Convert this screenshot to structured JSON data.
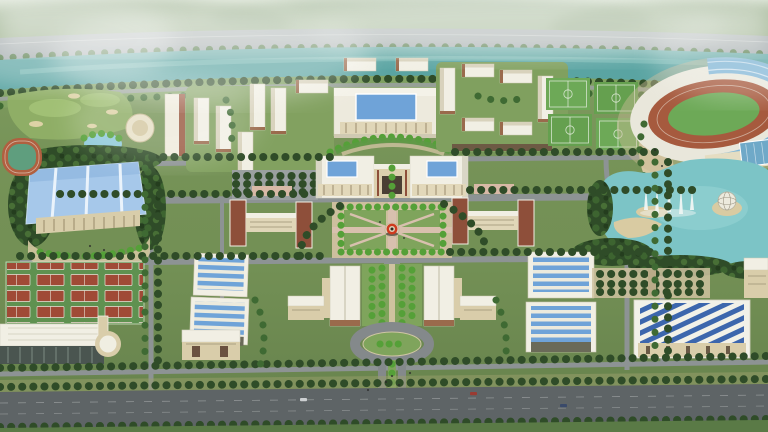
{
  "image": {
    "type": "architectural aerial rendering",
    "subject": "university campus master plan, bird's-eye perspective view",
    "style": "3D visualization with atmospheric haze, symmetric axial layout, river along top edge"
  },
  "palette": {
    "mist": "#dfe7da",
    "hills_green": "#7e9a6e",
    "embankment_road": "#9ba3a7",
    "river_teal": "#5aa4a2",
    "campus_green": "#7d995e",
    "lawn_green": "#7fa45c",
    "tree_dark": "#2f4c28",
    "tree_bright": "#55a038",
    "road_gray": "#8d9394",
    "main_road_gray": "#5e6466",
    "plaza_tan": "#cdbf9e",
    "building_cream": "#e9e4cd",
    "building_tan": "#d9cdaa",
    "roof_white": "#f1efe4",
    "skylight_blue": "#6fa3d8",
    "gym_roof_blue": "#a6c8ea",
    "stripe_blue": "#3c66ad",
    "stadium_track_red": "#a65a3e",
    "pitch_green": "#6da957",
    "court_green": "#5f9150",
    "court_red": "#a04a36",
    "lake_teal": "#7cc4c6",
    "brick_red": "#8e4f3a",
    "sculpture_red": "#cf3b1e",
    "sand_tan": "#d9cda4",
    "pond_blue": "#8ec9da"
  },
  "landmarks": [
    {
      "name": "river",
      "desc": "teal river with embankment road and tree-lined banks across the top"
    },
    {
      "name": "misty-hills",
      "desc": "hazy green hills fading into fog at the horizon"
    },
    {
      "name": "stadium",
      "desc": "oval stadium top right with red running track, green pitch and blue glass grandstand roof"
    },
    {
      "name": "soccer-fields",
      "desc": "four lined soccer pitches left of the stadium"
    },
    {
      "name": "lake-with-fountains",
      "desc": "kidney-shaped lake with white fountain jets and a spherical sculpture"
    },
    {
      "name": "gymnasium",
      "desc": "large light-blue-roofed gymnasium with semicircular forecourt, left side"
    },
    {
      "name": "running-track-field",
      "desc": "small track-and-field ring at far left edge"
    },
    {
      "name": "golf-knolls-and-pond",
      "desc": "landscaped mounds with sand bunkers and a small blue pond, upper left"
    },
    {
      "name": "dormitory-cluster-northwest",
      "desc": "white slab dormitories with a tall tower and round building"
    },
    {
      "name": "dormitory-quad-northeast",
      "desc": "white-roofed dormitory slabs around a green courtyard"
    },
    {
      "name": "main-library",
      "desc": "central main building with light-blue courtyard skylight"
    },
    {
      "name": "main-gate-complex",
      "desc": "twin white halls with blue skylights flanking the campus gate"
    },
    {
      "name": "terraced-arc-garden",
      "desc": "curved terraced hedge garden behind the gate"
    },
    {
      "name": "central-plaza",
      "desc": "square plaza ringed by trees with red ring sculpture at center"
    },
    {
      "name": "red-ring-sculpture",
      "desc": "red circular sculpture on plinth at plaza center"
    },
    {
      "name": "academic-buildings",
      "desc": "H-shaped teaching blocks with red-brick towers east and west of plaza"
    },
    {
      "name": "laboratory-buildings",
      "desc": "white lab blocks with blue striped skylight roofs"
    },
    {
      "name": "tennis-courts",
      "desc": "grid of sixteen red courts on green, lower left"
    },
    {
      "name": "natatorium",
      "desc": "long glass-fronted sports hall with cylindrical end, bottom left corner"
    },
    {
      "name": "auditorium",
      "desc": "small tan hall with white roof on south lawn"
    },
    {
      "name": "south-classroom-twins",
      "desc": "symmetric gable-roofed halls flanking the formal entrance garden"
    },
    {
      "name": "entrance-axis",
      "desc": "tree-planted axis with oval traffic island leading to main road"
    },
    {
      "name": "workshop-southeast",
      "desc": "building with blue-and-white striped roof, bottom right"
    },
    {
      "name": "main-road",
      "desc": "wide dark boulevard with street trees along the bottom edge"
    }
  ]
}
